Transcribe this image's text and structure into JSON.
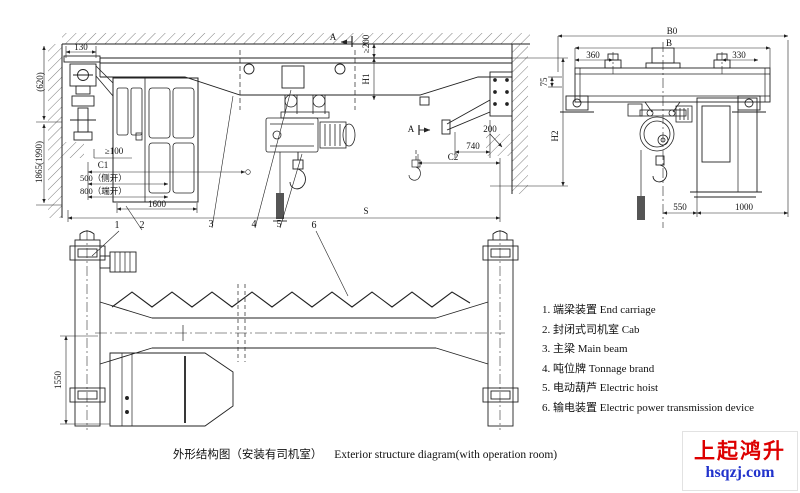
{
  "side_view": {
    "dims": {
      "d130": "130",
      "d620": "(620)",
      "d1865": "1865(1990)",
      "ge100": "≥100",
      "c1": "C1",
      "d500": "500（侧开）",
      "d800": "800（端开）",
      "d1600": "1600",
      "s": "S",
      "ge200": "≥200",
      "h1": "H1",
      "h2": "H2",
      "d200": "200",
      "d740": "740",
      "c2": "C2"
    },
    "section_mark": "A"
  },
  "end_view": {
    "dims": {
      "b0": "B0",
      "b": "B",
      "d360": "360",
      "d330": "330",
      "d75": "75",
      "d550": "550",
      "d1000": "1000"
    }
  },
  "plan_view": {
    "dims": {
      "d1550": "1550"
    },
    "callouts": [
      "1",
      "2",
      "3",
      "4",
      "5",
      "6"
    ]
  },
  "legend": {
    "items": [
      "1. 端梁装置 End carriage",
      "2. 封闭式司机室 Cab",
      "3. 主梁 Main beam",
      "4. 吨位牌 Tonnage brand",
      "5. 电动葫芦 Electric hoist",
      "6. 输电装置 Electric power transmission device"
    ]
  },
  "caption": {
    "zh": "外形结构图（安装有司机室）",
    "en": "Exterior structure diagram(with operation room)"
  },
  "logo": {
    "name": "上起鸿升",
    "domain": "hsqzj.com",
    "name_color": "#dd0000",
    "domain_color": "#2233cc"
  }
}
